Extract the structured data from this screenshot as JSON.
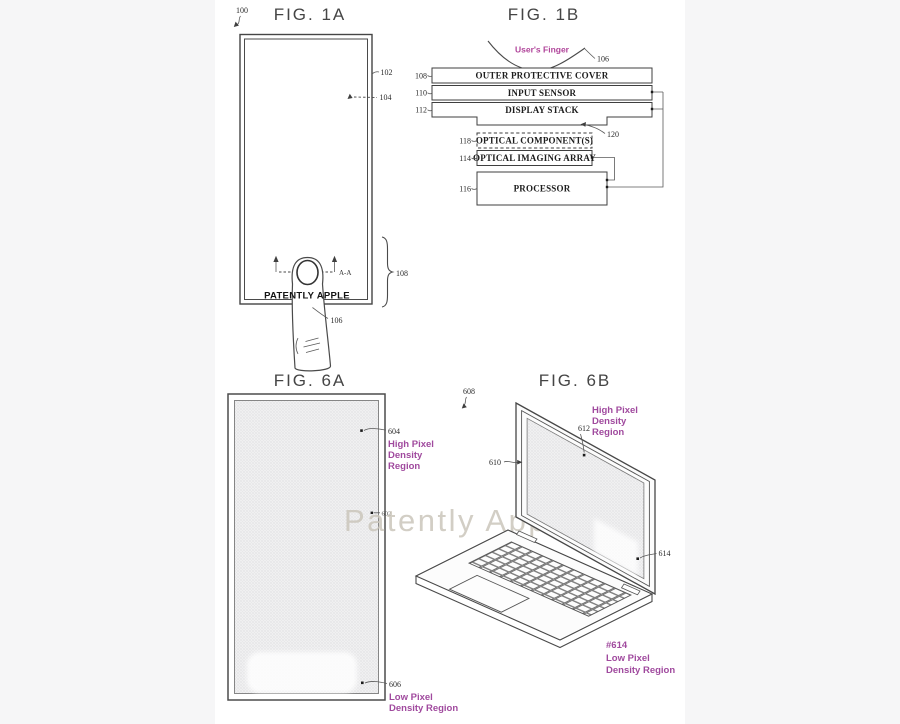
{
  "colors": {
    "purple": "#a04a9e",
    "magenta": "#b0449a",
    "line": "#4a4a4a",
    "watermark_gray": "#cbc6bb",
    "background": "#f6f6f7"
  },
  "watermark": "Patently Apple",
  "fig1a": {
    "title": "FIG. 1A",
    "brand": "PATENTLY APPLE",
    "section_marker": "A-A",
    "ref_100": "100",
    "ref_102": "102",
    "ref_104": "104",
    "ref_106": "106",
    "ref_108": "108"
  },
  "fig1b": {
    "title": "FIG. 1B",
    "finger_label": "User's Finger",
    "ref_106": "106",
    "ref_108": "108",
    "ref_110": "110",
    "ref_112": "112",
    "ref_114": "114",
    "ref_116": "116",
    "ref_118": "118",
    "ref_120": "120",
    "boxes": {
      "cover": "OUTER PROTECTIVE COVER",
      "sensor": "INPUT SENSOR",
      "display": "DISPLAY STACK",
      "optical": "OPTICAL COMPONENT(S)",
      "imaging": "OPTICAL IMAGING ARRAY",
      "processor": "PROCESSOR"
    }
  },
  "fig6a": {
    "title": "FIG. 6A",
    "ref_602": "602",
    "ref_604": "604",
    "ref_606": "606",
    "high_lines": [
      "High Pixel",
      "Density",
      "Region"
    ],
    "low_lines": [
      "Low Pixel",
      "Density Region"
    ]
  },
  "fig6b": {
    "title": "FIG. 6B",
    "ref_608": "608",
    "ref_610": "610",
    "ref_612": "612",
    "ref_614": "614",
    "ref_614_tag": "#614",
    "high_lines": [
      "High Pixel",
      "Density",
      "Region"
    ],
    "low_lines": [
      "Low Pixel",
      "Density Region"
    ]
  }
}
